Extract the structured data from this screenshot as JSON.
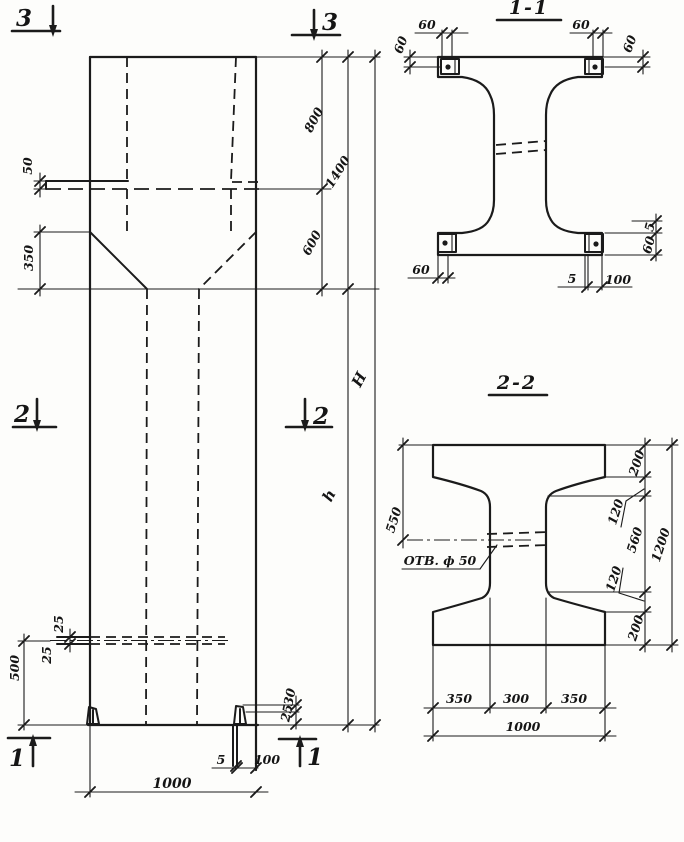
{
  "elevation": {
    "markers": {
      "top_left": "3",
      "top_right": "3",
      "mid_left": "2",
      "mid_right": "2",
      "bottom_left": "1",
      "bottom_right": "1"
    },
    "dims": {
      "ledge": "50",
      "haunch": "350",
      "cap_upper": "800",
      "cap_total": "1400",
      "haunch_zone": "600",
      "total_height": "H",
      "shaft_height": "h",
      "hole_top": "25",
      "hole_bottom": "25",
      "hole_elevation": "500",
      "foot_upper": "30",
      "foot_lower": "25",
      "base_plate_thk": "5",
      "base_plate_w": "100",
      "width": "1000"
    }
  },
  "section_1_1": {
    "title": "1-1",
    "dims": {
      "top_left_w": "60",
      "top_left_h": "60",
      "top_right_w": "60",
      "top_right_h": "60",
      "bottom_left_w": "60",
      "bottom_thk": "5",
      "bottom_w": "100",
      "right_gap": "5",
      "right_h": "60"
    }
  },
  "section_2_2": {
    "title": "2-2",
    "hole_label": "ОТВ. ф 50",
    "dims": {
      "left_top": "550",
      "right_top": "200",
      "right_upper_notch": "120",
      "right_mid": "560",
      "right_lower_notch": "120",
      "right_bottom": "200",
      "right_total": "1200",
      "bottom_left": "350",
      "bottom_mid": "300",
      "bottom_right": "350",
      "bottom_total": "1000"
    }
  }
}
